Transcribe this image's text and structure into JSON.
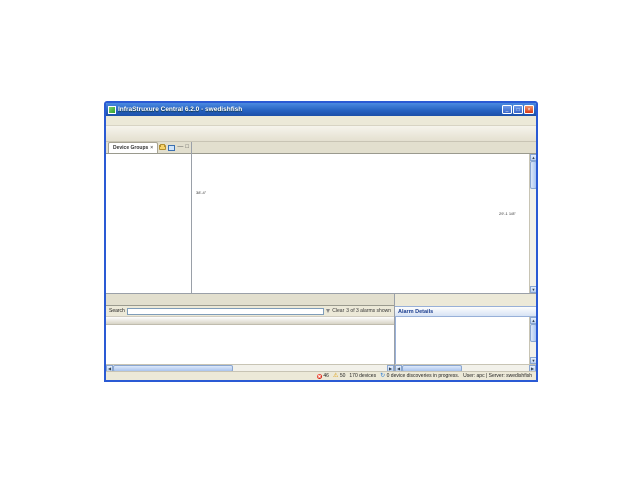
{
  "window": {
    "title": "InfraStruxure Central 6.2.0 - swedishfish",
    "menu": [
      "File",
      "Device",
      "Alarm Configuration",
      "Reports",
      "Updates",
      "System",
      "Window",
      "Help"
    ],
    "toolbar": [
      {
        "label": "Monitoring",
        "glyph": "✓",
        "color": "#2f9e2f",
        "active": true
      },
      {
        "label": "Surveillance",
        "glyph": "◉",
        "color": "#2f7fd3",
        "active": false
      },
      {
        "label": "Alarm Configuration",
        "glyph": "⚑",
        "color": "#e87c1e",
        "active": false
      },
      {
        "label": "Reports",
        "glyph": "▤",
        "color": "#3a9bbf",
        "active": false
      },
      {
        "label": "Power Management",
        "glyph": "⚡",
        "color": "#2fae4a",
        "active": false
      }
    ]
  },
  "device_groups": {
    "tab_label": "Device Groups",
    "tree": [
      {
        "label": "All Devices",
        "level": 0,
        "exp": "-",
        "icon": "alarm"
      },
      {
        "label": "Unassigned",
        "level": 1,
        "exp": null,
        "icon": "folder"
      },
      {
        "label": "Brazil",
        "level": 1,
        "exp": "-",
        "icon": "alarm"
      },
      {
        "label": "Sao Paulo",
        "level": 2,
        "exp": null,
        "icon": "alarm"
      },
      {
        "label": "Canada",
        "level": 1,
        "exp": "-",
        "icon": "alarm"
      },
      {
        "label": "Ontario",
        "level": 2,
        "exp": null,
        "icon": "alarm"
      },
      {
        "label": "China",
        "level": 1,
        "exp": "-",
        "icon": "alarm"
      },
      {
        "label": "Beijing",
        "level": 2,
        "exp": null,
        "icon": "alarm"
      },
      {
        "label": "France",
        "level": 1,
        "exp": "-",
        "icon": "alarm"
      },
      {
        "label": "Paris",
        "level": 2,
        "exp": null,
        "icon": "alarm"
      },
      {
        "label": "India",
        "level": 1,
        "exp": "-",
        "icon": "alarm"
      },
      {
        "label": "Hyderabad",
        "level": 2,
        "exp": null,
        "icon": "alarm"
      },
      {
        "label": "Japan",
        "level": 1,
        "exp": "-",
        "icon": "alarm"
      },
      {
        "label": "Tokyo",
        "level": 2,
        "exp": null,
        "icon": "alarm"
      },
      {
        "label": "Russia",
        "level": 1,
        "exp": "-",
        "icon": "alarm"
      },
      {
        "label": "St. Petersburg",
        "level": 2,
        "exp": null,
        "icon": "alarm"
      },
      {
        "label": "Spain",
        "level": 1,
        "exp": "-",
        "icon": "alarm"
      },
      {
        "label": "Madrid",
        "level": 2,
        "exp": null,
        "icon": "alarm"
      },
      {
        "label": "UK",
        "level": 1,
        "exp": "-",
        "icon": "alarm"
      },
      {
        "label": "London",
        "level": 2,
        "exp": null,
        "icon": "alarm"
      },
      {
        "label": "US",
        "level": 1,
        "exp": "-",
        "icon": "alarm"
      },
      {
        "label": "CA",
        "level": 2,
        "exp": "+",
        "icon": "alarm"
      },
      {
        "label": "FL",
        "level": 2,
        "exp": "+",
        "icon": "alarm"
      },
      {
        "label": "RI",
        "level": 2,
        "exp": "-",
        "icon": "alarm"
      },
      {
        "label": "Providence",
        "level": 3,
        "exp": null,
        "icon": "alarm"
      }
    ]
  },
  "map_panel": {
    "tabs": [
      {
        "label": "Device View",
        "active": false,
        "closable": false
      },
      {
        "label": "Map View",
        "active": true,
        "closable": true
      }
    ],
    "toolbar_icons": [
      {
        "glyph": "+",
        "name": "zoom-in-icon"
      },
      {
        "glyph": "−",
        "name": "zoom-out-icon"
      },
      {
        "glyph": "✎",
        "name": "edit-icon",
        "green": true
      },
      {
        "glyph": "▦",
        "name": "grid-icon"
      },
      {
        "glyph": "▤",
        "name": "rows-icon"
      },
      {
        "glyph": "▥",
        "name": "columns-icon"
      },
      {
        "glyph": "↖",
        "name": "select-icon"
      },
      {
        "glyph": "▧",
        "name": "layers-icon"
      },
      {
        "glyph": "A",
        "name": "label-icon"
      }
    ],
    "dimension_left": "38'-4\"",
    "dimension_right": "29'-1 1/8\"",
    "items": [
      {
        "type": "rack",
        "x": 64,
        "y": 11,
        "label": "Rack Access Pod 170 ..."
      },
      {
        "type": "rack",
        "x": 104,
        "y": 11,
        "label": "Rack Access Pod 170 ..."
      },
      {
        "type": "rack",
        "x": 238,
        "y": 11,
        "label": "Rack Access Pod 170 ..."
      },
      {
        "type": "rack",
        "x": 276,
        "y": 11,
        "label": "Rack Access Pod 170 ..."
      },
      {
        "type": "netbotz",
        "x": 64,
        "y": 73,
        "label": "NetBotz Rack Monitor",
        "alarm": true
      },
      {
        "type": "rack",
        "x": 124,
        "y": 73,
        "label": "Rack Access Pod 170 ..."
      },
      {
        "type": "rack",
        "x": 166,
        "y": 73,
        "label": "Rack Access Pod 170 ..."
      },
      {
        "type": "rack",
        "x": 226,
        "y": 73,
        "label": "Rack Access Pod 170 ..."
      },
      {
        "type": "door",
        "x": 82,
        "y": 103,
        "label": "Closed\nDoor (1)..."
      },
      {
        "type": "reader",
        "x": 182,
        "y": 103,
        "label": "Enabled\nReader (1)..."
      },
      {
        "type": "handle",
        "x": 246,
        "y": 103,
        "label": "Open\nHandle (1)..."
      }
    ]
  },
  "alarms": {
    "tabs": [
      {
        "label": "Active Alarms",
        "active": true,
        "closable": true
      },
      {
        "label": "Saved Discoveries",
        "active": false,
        "closable": false
      }
    ],
    "search_label": "Search",
    "clear_label": "Clear",
    "count_text": "3 of 3 alarms shown",
    "columns": [
      "Clip",
      "Description",
      "Severity",
      "Device Hostname",
      "Alarm Type",
      "Location"
    ],
    "rows": [
      {
        "clip": false,
        "description": "The link 'http://10.218.10.239:80' is not currently functioning corre...",
        "severity": "Failure",
        "hostname": "NetBotz Rack Monitor 550",
        "alarm_type": "Link Failed",
        "location": "West Kingston"
      },
      {
        "clip": true,
        "description": "The value of 'Ethernet Link Status' (Up) indicates that a 'Error' alert ...",
        "severity": "Error",
        "hostname": "NetBotz Rack Monitor 550",
        "alarm_type": "Value Error",
        "location": "West Kingston"
      },
      {
        "clip": false,
        "description": "The system was configured to use an add-on or network drive for s...",
        "severity": "Failure",
        "hostname": "NetBotz Rack Monitor 550",
        "alarm_type": "Drive Not Found",
        "location": "West Kingston"
      }
    ]
  },
  "details": {
    "title": "Alarm Details",
    "toolbar_icons": [
      {
        "glyph": "»",
        "name": "fast-forward-icon",
        "blue": true
      },
      {
        "glyph": "▦",
        "name": "grid-icon"
      },
      {
        "glyph": "◆",
        "name": "marker-icon"
      },
      {
        "glyph": "—",
        "name": "minimize-panel-icon"
      },
      {
        "glyph": "□",
        "name": "maximize-panel-icon"
      }
    ],
    "sections": [
      {
        "label": "Description",
        "expanded": true,
        "text": "The value of 'Ethernet Link Status' (Up) indicates that a 'Error' alert has occurred."
      },
      {
        "label": "Device Hostname",
        "expanded": false,
        "text": ""
      },
      {
        "label": "Alarm Name",
        "expanded": false,
        "text": ""
      },
      {
        "label": "Recommended Actions",
        "expanded": false,
        "text": ""
      }
    ]
  },
  "status": {
    "critical_count": "46",
    "warning_count": "50",
    "devices_text": "170 devices",
    "discovery_text": "0 device discoveries in progress.",
    "session_text": "User: apc | Server: swedishfish"
  }
}
